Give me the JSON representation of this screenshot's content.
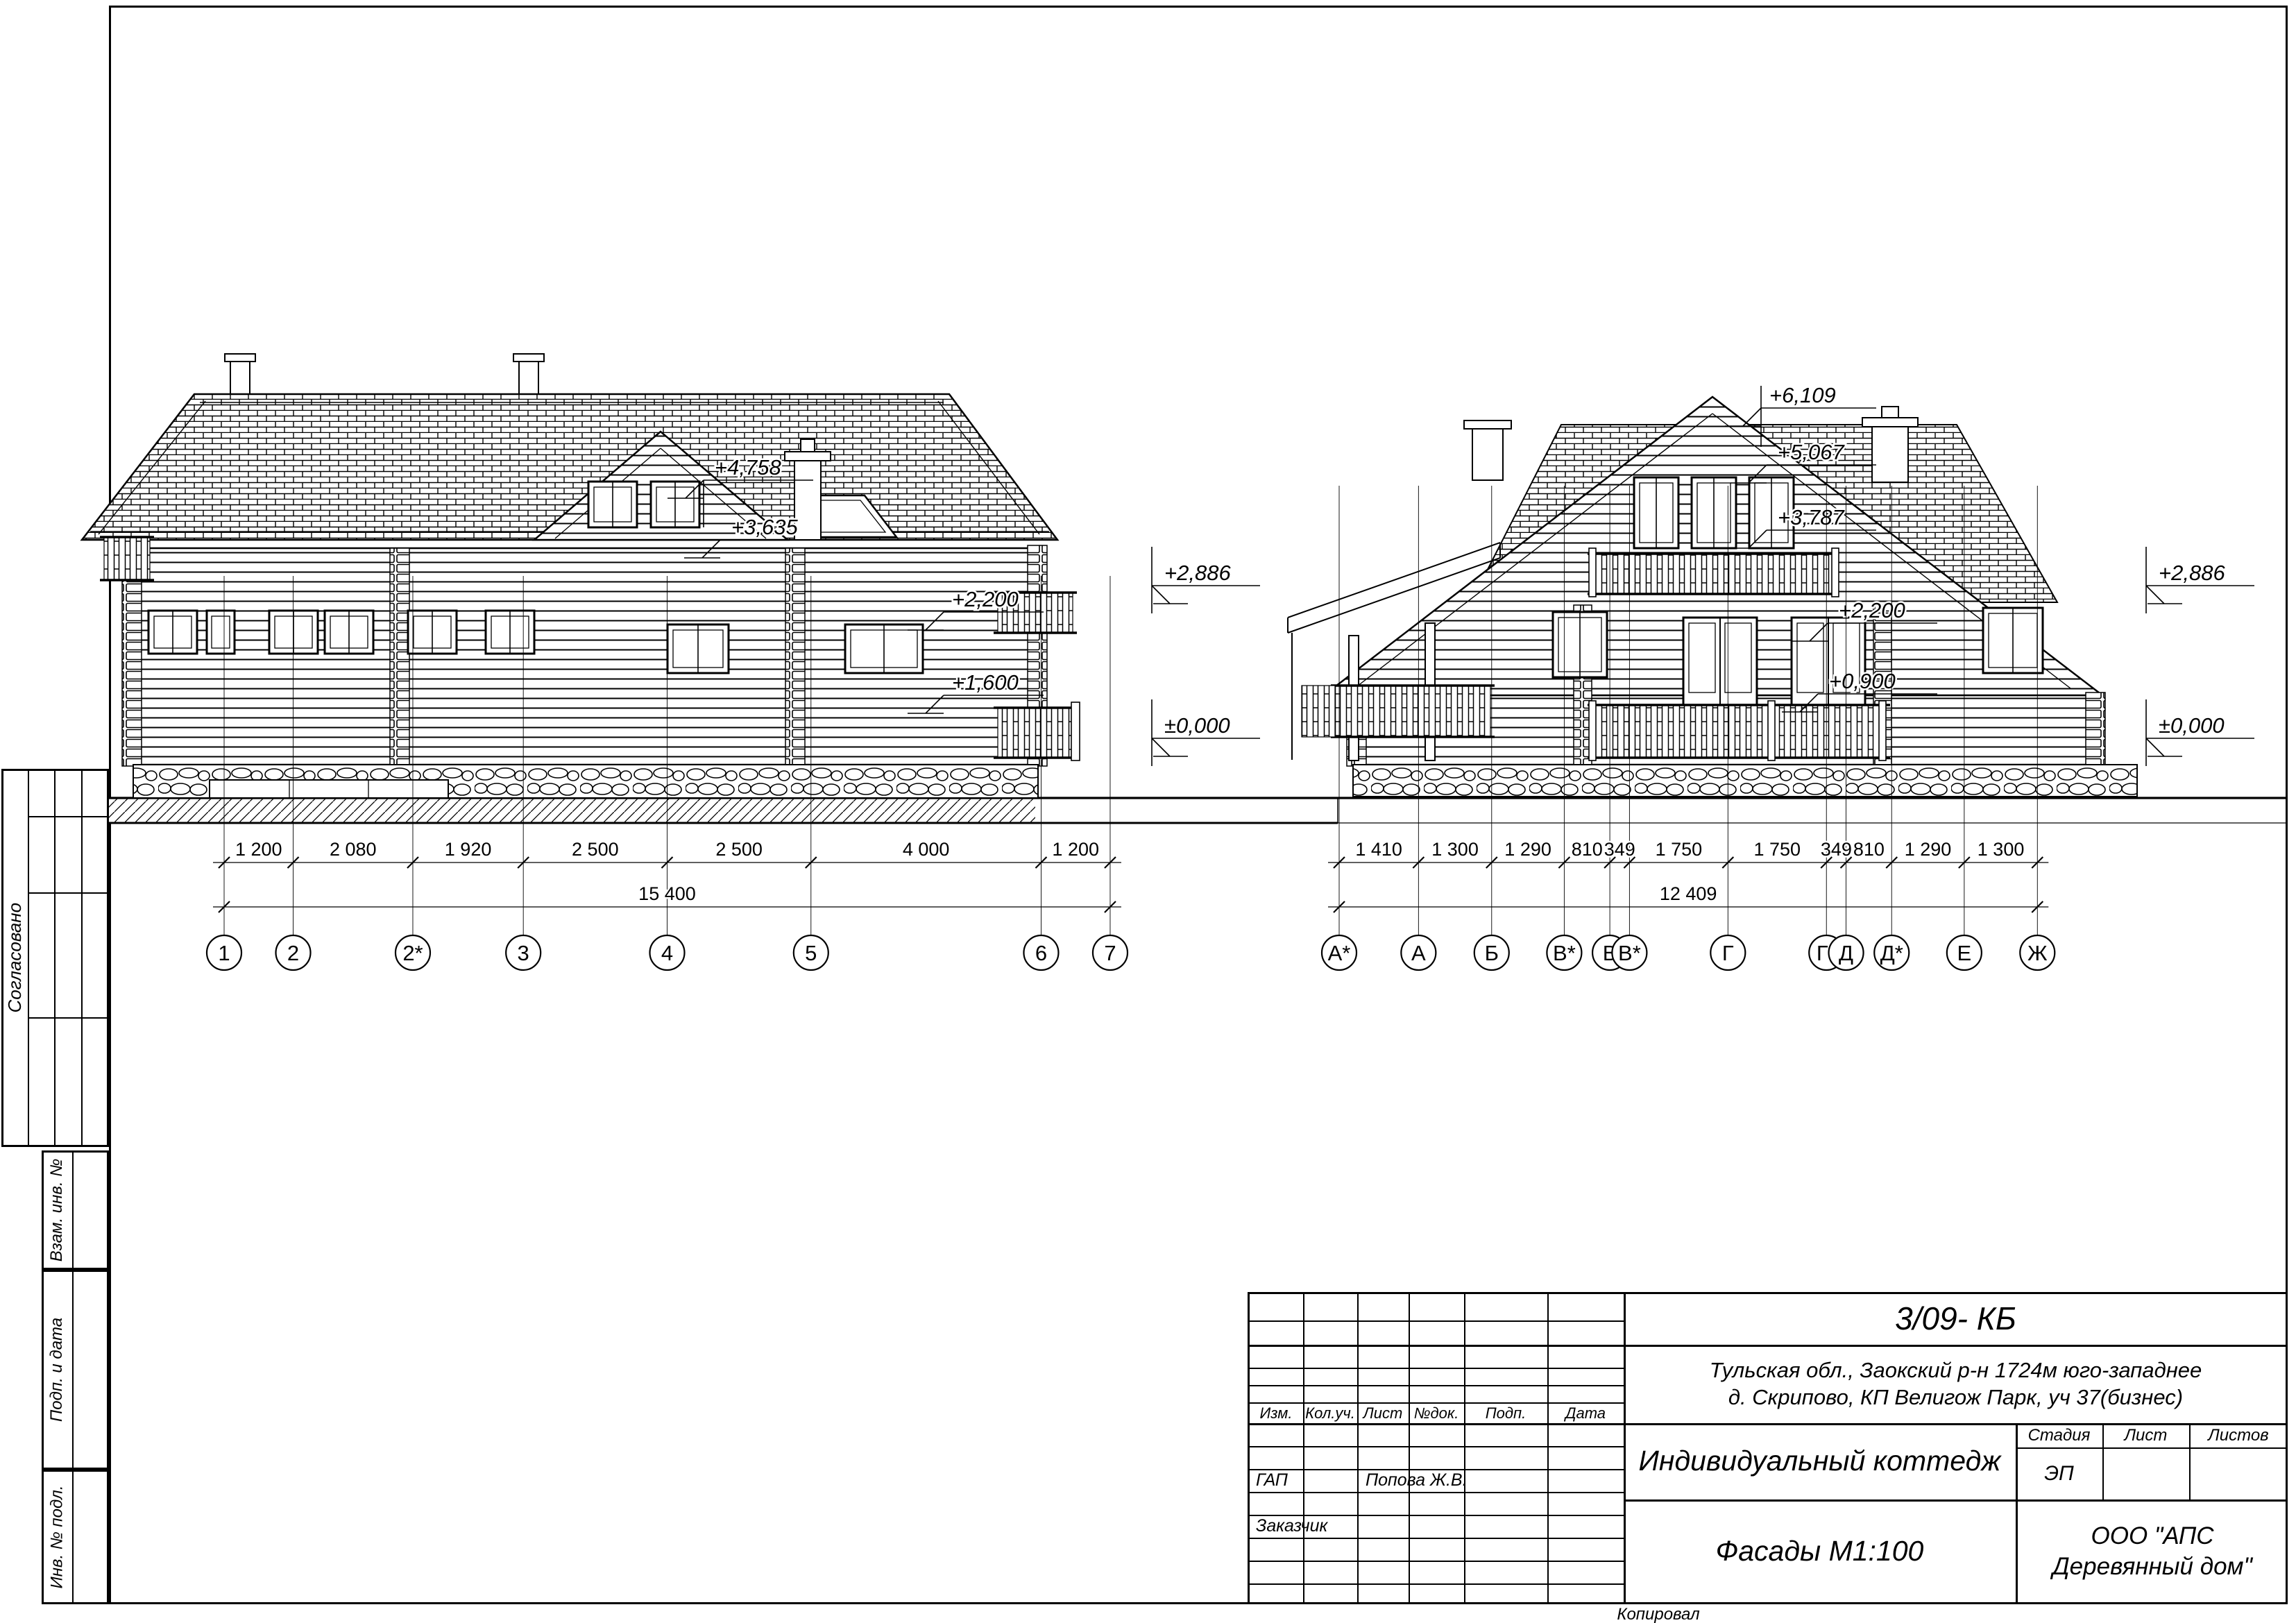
{
  "sheet": {
    "code": "3/09- КБ",
    "address_line1": "Тульская обл., Заокский р-н 1724м юго-западнее",
    "address_line2": "д. Скрипово, КП Велигож Парк, уч 37(бизнес)",
    "object_title": "Индивидуальный коттедж",
    "drawing_title": "Фасады М1:100",
    "company": "ООО \"АПС Деревянный дом\"",
    "stage_label": "Стадия",
    "sheet_label": "Лист",
    "sheets_label": "Листов",
    "stage_value": "ЭП",
    "columns": {
      "izm": "Изм.",
      "kol": "Кол.уч.",
      "list": "Лист",
      "ndok": "№док.",
      "podp": "Подп.",
      "data": "Дата"
    },
    "gap_label": "ГАП",
    "gap_value": "Попова Ж.В.",
    "customer_label": "Заказчик",
    "copied_by": "Копировал",
    "side": {
      "approved": "Согласовано",
      "vzam": "Взам. инв. №",
      "podp": "Подп. и дата",
      "inv": "Инв. № подл."
    }
  },
  "left_facade": {
    "axes": [
      "1",
      "2",
      "2*",
      "3",
      "4",
      "5",
      "6",
      "7"
    ],
    "segments_mm": [
      1200,
      2080,
      1920,
      2500,
      2500,
      4000,
      1200
    ],
    "segment_labels": [
      "1 200",
      "2 080",
      "1 920",
      "2 500",
      "2 500",
      "4 000",
      "1 200"
    ],
    "total_label": "15 400",
    "marks": {
      "ridge": "+4,758",
      "dormer": "+3,635",
      "upper_right": "+2,200",
      "mid_right": "+1,600",
      "eaves": "+2,886",
      "ground": "±0,000"
    }
  },
  "right_facade": {
    "axes": [
      "А*",
      "А",
      "Б",
      "В*",
      "В",
      "В*",
      "Г",
      "Г*",
      "Д",
      "Д*",
      "Е",
      "Ж"
    ],
    "segments_mm": [
      1410,
      1300,
      1290,
      810,
      349,
      1750,
      1750,
      349,
      810,
      1290,
      1300
    ],
    "segment_labels": [
      "1 410",
      "1 300",
      "1 290",
      "810",
      "349",
      "1 750",
      "1 750",
      "349",
      "810",
      "1 290",
      "1 300"
    ],
    "total_label": "12 409",
    "marks": {
      "ridge": "+6,109",
      "roof_edge": "+5,067",
      "gable": "+3,787",
      "balcony": "+2,200",
      "porch": "+0,900",
      "eaves": "+2,886",
      "ground": "±0,000"
    }
  }
}
